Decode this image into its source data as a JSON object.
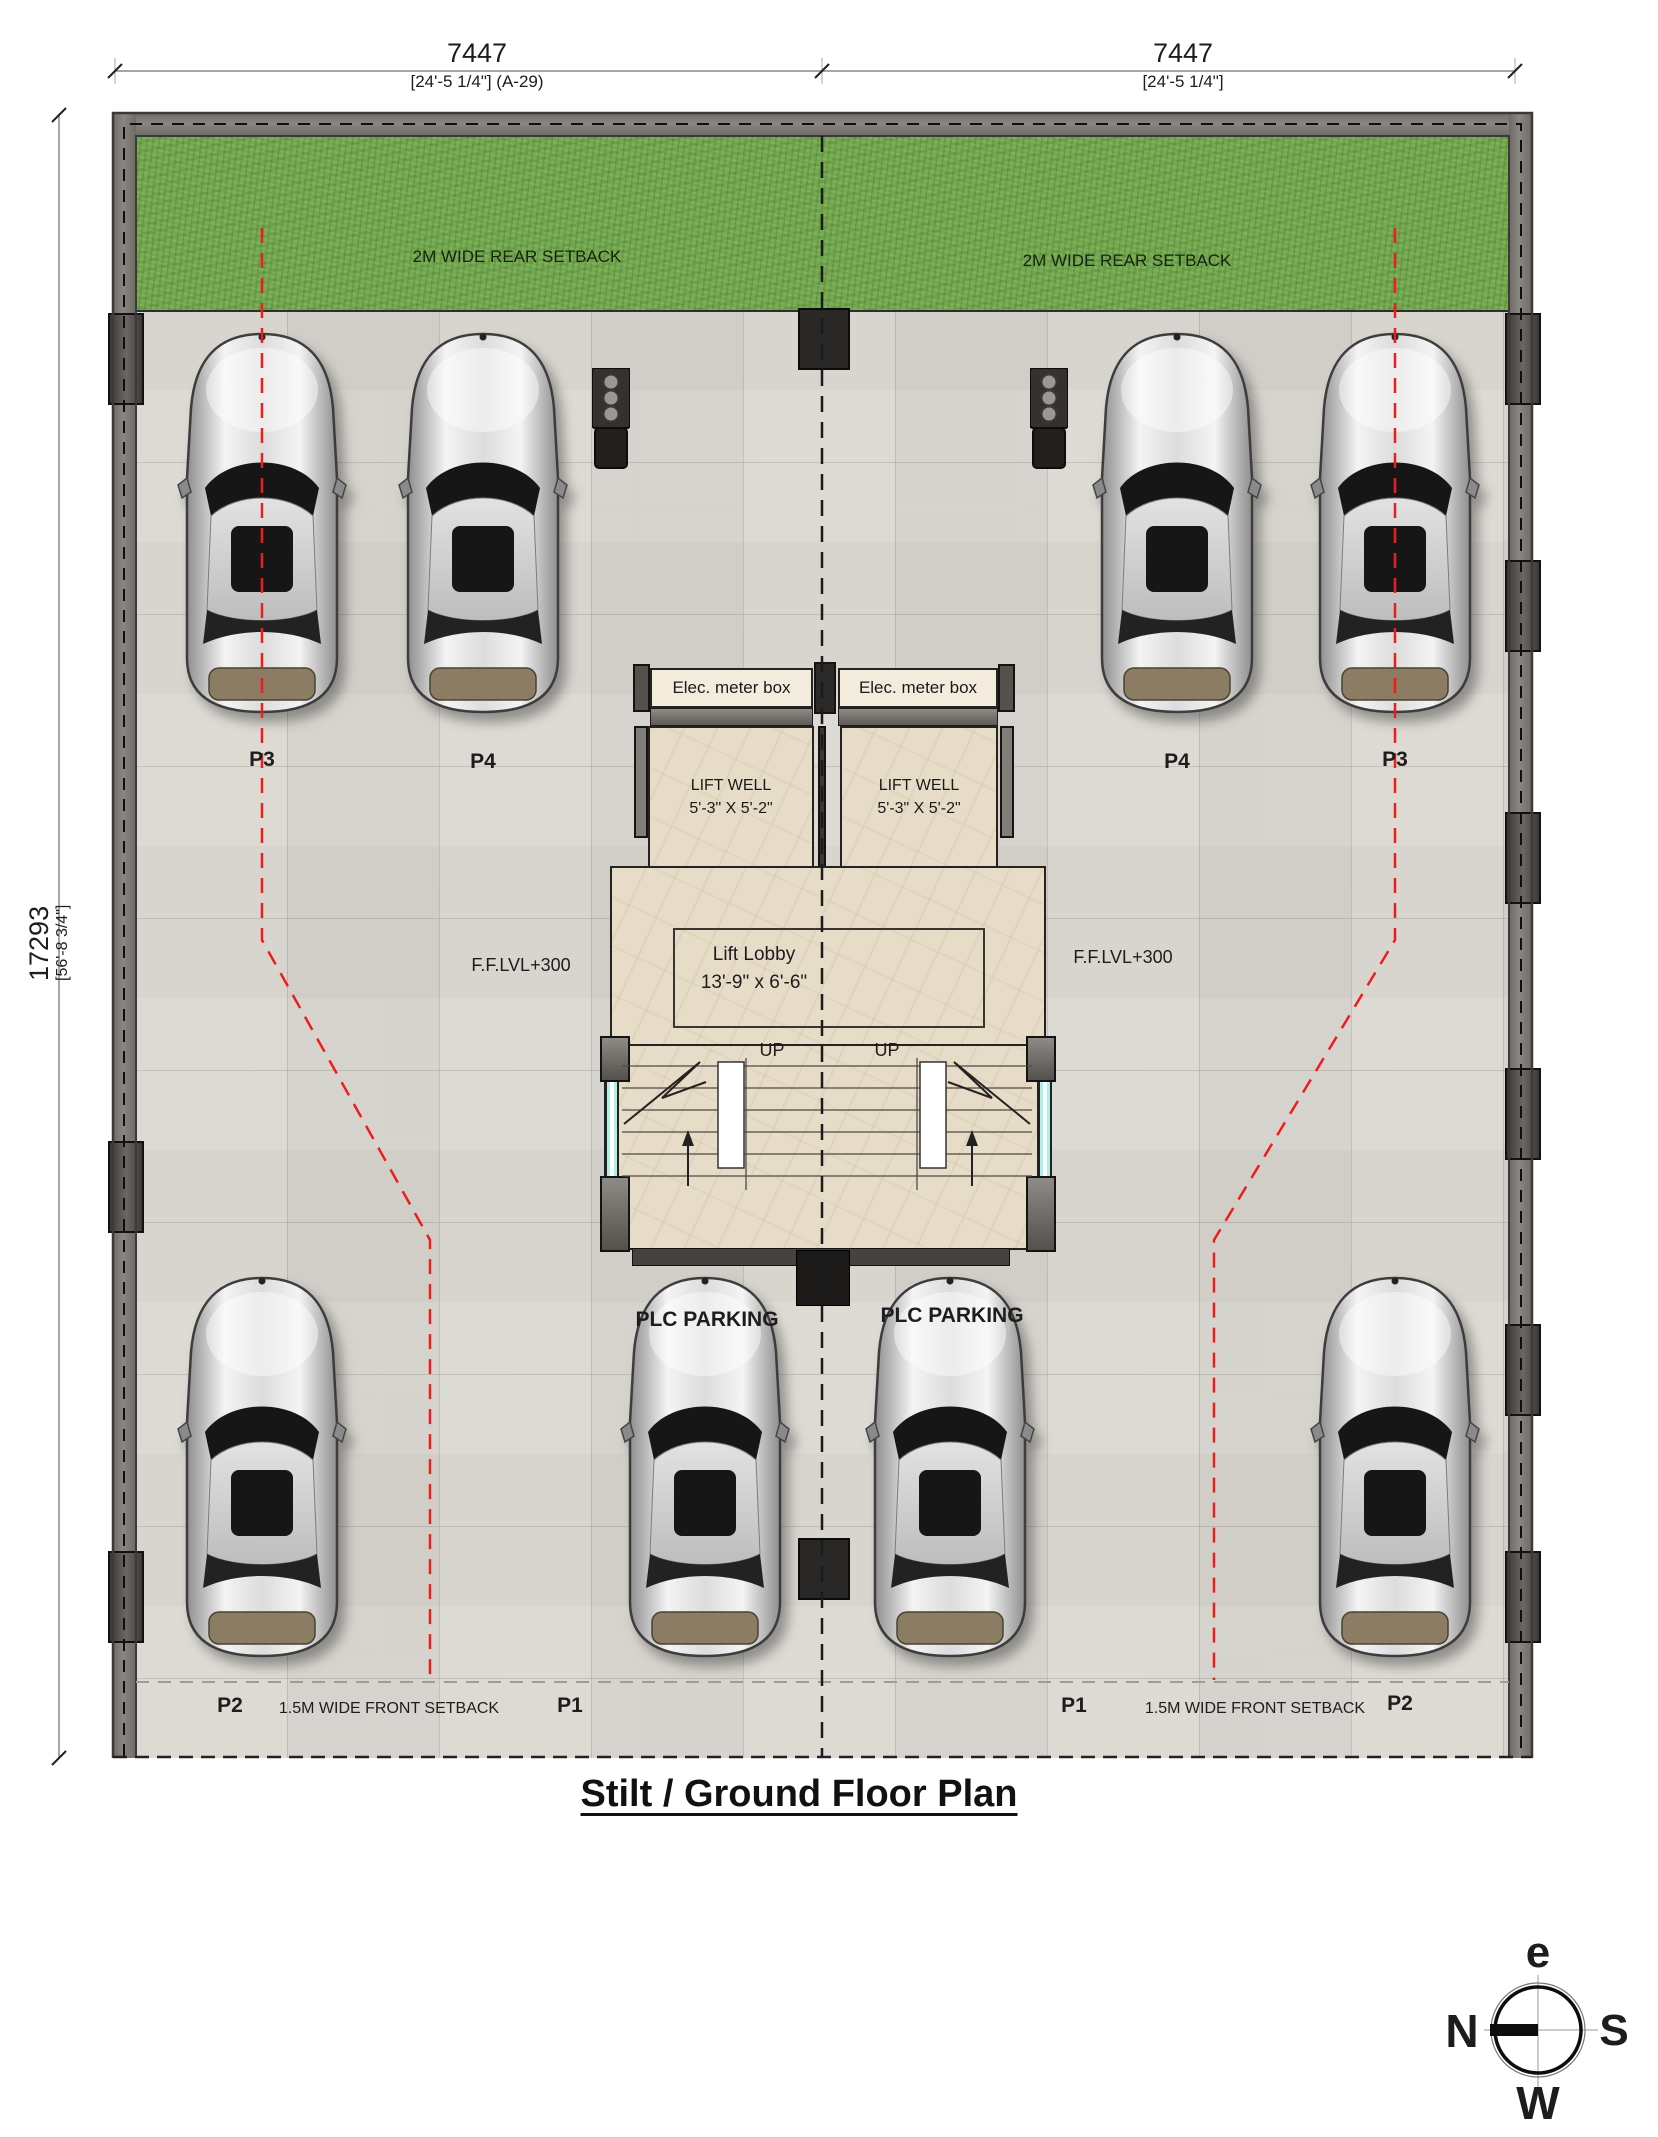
{
  "title": "Stilt / Ground Floor Plan",
  "dimensions": {
    "top_left_value": "7447",
    "top_left_detail": "[24'-5 1/4\"] (A-29)",
    "top_right_value": "7447",
    "top_right_detail": "[24'-5 1/4\"]",
    "left_value": "17293",
    "left_detail": "[56'-8 3/4\"]"
  },
  "setbacks": {
    "rear_left": "2M WIDE REAR SETBACK",
    "rear_right": "2M WIDE REAR SETBACK",
    "front_left": "1.5M WIDE FRONT SETBACK",
    "front_right": "1.5M WIDE FRONT SETBACK"
  },
  "levels": {
    "ffl_left": "F.F.LVL+300",
    "ffl_right": "F.F.LVL+300"
  },
  "core": {
    "elec_left": "Elec. meter box",
    "elec_right": "Elec. meter box",
    "liftwell_left_1": "LIFT WELL",
    "liftwell_left_2": "5'-3\" X 5'-2\"",
    "liftwell_right_1": "LIFT WELL",
    "liftwell_right_2": "5'-3\" X 5'-2\"",
    "lobby_1": "Lift Lobby",
    "lobby_2": "13'-9\" x 6'-6\"",
    "up_left": "UP",
    "up_right": "UP"
  },
  "parking": {
    "plc_left": "PLC PARKING",
    "plc_right": "PLC PARKING",
    "spot_top_1": "P3",
    "spot_top_2": "P4",
    "spot_top_3": "P4",
    "spot_top_4": "P3",
    "spot_bottom_1": "P2",
    "spot_bottom_2": "P1",
    "spot_bottom_3": "P1",
    "spot_bottom_4": "P2"
  },
  "compass": {
    "top": "e",
    "left": "N",
    "right": "S",
    "bottom": "W"
  },
  "colors": {
    "grass": "#74a94f",
    "floor": "#e4e1db",
    "wall": "#7a7672",
    "marble": "#e2d7c0",
    "guide_red": "#ee1d1d",
    "glass": "#aff0e9",
    "centerline": "#1b1b1b"
  }
}
